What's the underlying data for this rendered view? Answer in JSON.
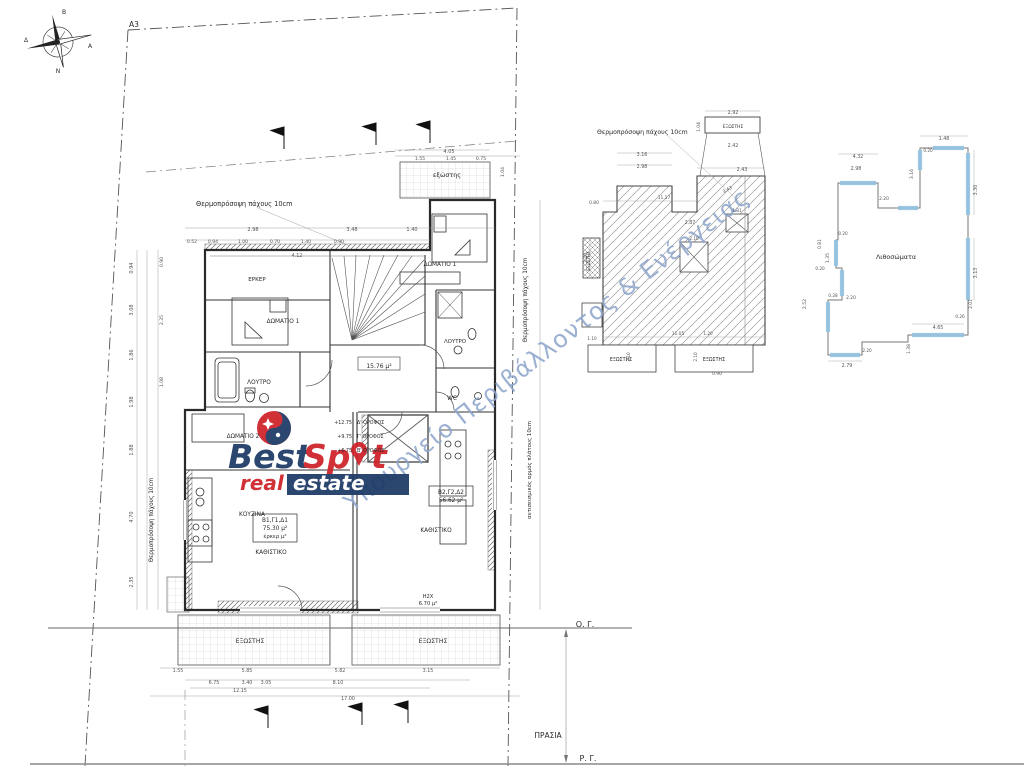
{
  "watermark": "Υπουργείο Περιβάλλοντος & Ενέργειας",
  "logo": {
    "best": "Best",
    "spot_left": "Sp",
    "spot_right": "t",
    "real": "real",
    "estate": "estate",
    "red": "#cf2128",
    "navy": "#1c3a66"
  },
  "site": {
    "corner_label": "A3",
    "building_line": "Ο. Γ.",
    "street_line": "Ρ. Γ.",
    "front_garden": "ΠΡΑΣΙΑ"
  },
  "labels": [
    {
      "n": "label-a3",
      "t": "A3",
      "x": 134,
      "y": 27,
      "s": 7.5
    },
    {
      "n": "compass-n-label",
      "t": "Β",
      "x": 64,
      "y": 14,
      "s": 6
    },
    {
      "n": "compass-s-label",
      "t": "Ν",
      "x": 58,
      "y": 73,
      "s": 6
    },
    {
      "n": "compass-e-label",
      "t": "Α",
      "x": 90,
      "y": 48,
      "s": 6
    },
    {
      "n": "compass-w-label",
      "t": "Δ",
      "x": 26,
      "y": 42,
      "s": 6
    },
    {
      "n": "anno-thermo-top",
      "t": "Θερμοπρόσοψη πάχους 10cm",
      "x": 196,
      "y": 206,
      "s": 6.6,
      "a": "start"
    },
    {
      "n": "label-exostis-small",
      "t": "εξώστης",
      "x": 447,
      "y": 177,
      "s": 6.4
    },
    {
      "n": "label-domatio1-right",
      "t": "ΔΩΜΑΤΙΟ 1",
      "x": 440,
      "y": 266,
      "s": 5.8
    },
    {
      "n": "label-erker",
      "t": "ΕΡΚΕΡ",
      "x": 257,
      "y": 281,
      "s": 5.6
    },
    {
      "n": "label-domatio1-left",
      "t": "ΔΩΜΑΤΙΟ 1",
      "x": 283,
      "y": 323,
      "s": 5.8
    },
    {
      "n": "label-loutro-left",
      "t": "ΛΟΥΤΡΟ",
      "x": 259,
      "y": 384,
      "s": 5.8
    },
    {
      "n": "label-area-1576",
      "t": "15.76 μ²",
      "x": 379,
      "y": 368,
      "s": 6
    },
    {
      "n": "label-loutro-right",
      "t": "ΛΟΥΤΡΟ",
      "x": 455,
      "y": 343,
      "s": 5.4
    },
    {
      "n": "label-wc",
      "t": "WC",
      "x": 452,
      "y": 400,
      "s": 5.8
    },
    {
      "n": "label-domatio2",
      "t": "ΔΩΜΑΤΙΟ 2",
      "x": 243,
      "y": 438,
      "s": 5.8
    },
    {
      "n": "label-kouzina",
      "t": "ΚΟΥΖΙΝΑ",
      "x": 252,
      "y": 516,
      "s": 5.8
    },
    {
      "n": "label-apt1-code",
      "t": "Β1,Γ1,Δ1",
      "x": 275,
      "y": 522,
      "s": 5.8
    },
    {
      "n": "label-apt1-area",
      "t": "75.30 μ²",
      "x": 275,
      "y": 530,
      "s": 5.8
    },
    {
      "n": "label-apt1-erker",
      "t": "έρκερ μ²",
      "x": 275,
      "y": 538,
      "s": 5.4
    },
    {
      "n": "label-kathistiko-left",
      "t": "ΚΑΘΙΣΤΙΚΟ",
      "x": 271,
      "y": 554,
      "s": 5.8
    },
    {
      "n": "label-apt2-code",
      "t": "Β2,Γ2,Δ2",
      "x": 451,
      "y": 494,
      "s": 5.8
    },
    {
      "n": "label-apt2-area",
      "t": "56.62 μ²",
      "x": 451,
      "y": 502,
      "s": 5.8
    },
    {
      "n": "label-kathistiko-right",
      "t": "ΚΑΘΙΣΤΙΚΟ",
      "x": 436,
      "y": 532,
      "s": 5.8
    },
    {
      "n": "label-h2x",
      "t": "Η2Χ",
      "x": 428,
      "y": 598,
      "s": 5.2
    },
    {
      "n": "label-h2x-area",
      "t": "6.70 μ²",
      "x": 428,
      "y": 605,
      "s": 5.2
    },
    {
      "n": "label-exostis-bl",
      "t": "ΕΞΩΣΤΗΣ",
      "x": 250,
      "y": 643,
      "s": 6.2
    },
    {
      "n": "label-exostis-br",
      "t": "ΕΞΩΣΤΗΣ",
      "x": 433,
      "y": 643,
      "s": 6.2
    },
    {
      "n": "floor-d-level",
      "t": "+12.75",
      "x": 352,
      "y": 424,
      "s": 4.8,
      "a": "end"
    },
    {
      "n": "floor-d-label",
      "t": "Δ' ΟΡΟΦΟΣ",
      "x": 357,
      "y": 424,
      "s": 4.8,
      "a": "start"
    },
    {
      "n": "floor-c-level",
      "t": "+9.75",
      "x": 352,
      "y": 438,
      "s": 4.8,
      "a": "end"
    },
    {
      "n": "floor-c-label",
      "t": "Γ' ΟΡΟΦΟΣ",
      "x": 357,
      "y": 438,
      "s": 4.8,
      "a": "start"
    },
    {
      "n": "floor-b-level",
      "t": "+6.75",
      "x": 352,
      "y": 452,
      "s": 4.8,
      "a": "end"
    },
    {
      "n": "floor-b-label",
      "t": "Β' ΟΡΟΦΟΣ",
      "x": 357,
      "y": 452,
      "s": 4.8,
      "a": "start"
    },
    {
      "n": "anno-thermo-left",
      "t": "Θερμοπρόσοψη πάχους 10cm",
      "x": 153,
      "y": 520,
      "s": 5.8,
      "r": -90
    },
    {
      "n": "anno-thermo-right",
      "t": "Θερμοπρόσοψη πάχους 10cm",
      "x": 527,
      "y": 300,
      "s": 5.8,
      "r": -90
    },
    {
      "n": "anno-seismic-joint",
      "t": "αντισεισμικός αρμός πλάτους 10cm",
      "x": 531,
      "y": 470,
      "s": 5.4,
      "r": -90
    },
    {
      "n": "label-og",
      "t": "Ο. Γ.",
      "x": 585,
      "y": 627,
      "s": 8
    },
    {
      "n": "label-prasia",
      "t": "ΠΡΑΣΙΑ",
      "x": 548,
      "y": 738,
      "s": 7.5
    },
    {
      "n": "label-rg",
      "t": "Ρ. Γ.",
      "x": 588,
      "y": 761,
      "s": 8
    },
    {
      "n": "anno-thermo-mid",
      "t": "Θερμοπρόσοψη πάχους 10cm",
      "x": 597,
      "y": 134,
      "s": 6.2,
      "a": "start"
    },
    {
      "n": "label-mid-exostis-top",
      "t": "ΕΞΩΣΤΗΣ",
      "x": 733,
      "y": 128,
      "s": 4.4
    },
    {
      "n": "label-mid-exostis-left",
      "t": "ΕΞΩΣΤΗΣ",
      "x": 590,
      "y": 261,
      "s": 4.2,
      "r": -90
    },
    {
      "n": "label-mid-exostis-bl",
      "t": "ΕΞΩΣΤΗΣ",
      "x": 621,
      "y": 361,
      "s": 4.8
    },
    {
      "n": "label-mid-exostis-br",
      "t": "ΕΞΩΣΤΗΣ",
      "x": 714,
      "y": 361,
      "s": 4.8
    },
    {
      "n": "label-lithosomata",
      "t": "Λιθοσώματα",
      "x": 896,
      "y": 259,
      "s": 6.4
    }
  ],
  "dims": [
    {
      "t": "4.05",
      "x": 449,
      "y": 153
    },
    {
      "t": "1.55",
      "x": 420,
      "y": 160,
      "s": 4.6
    },
    {
      "t": "1.45",
      "x": 451,
      "y": 160,
      "s": 4.6
    },
    {
      "t": "0.75",
      "x": 481,
      "y": 160,
      "s": 4.6
    },
    {
      "t": "1.04",
      "x": 504,
      "y": 172,
      "r": -90,
      "s": 4.6
    },
    {
      "t": "2.98",
      "x": 253,
      "y": 231
    },
    {
      "t": "3.48",
      "x": 352,
      "y": 231
    },
    {
      "t": "1.40",
      "x": 412,
      "y": 231
    },
    {
      "t": "0.52",
      "x": 192,
      "y": 243,
      "s": 4.6
    },
    {
      "t": "0.94",
      "x": 213,
      "y": 243,
      "s": 4.6
    },
    {
      "t": "1.00",
      "x": 243,
      "y": 243,
      "s": 4.6
    },
    {
      "t": "0.70",
      "x": 275,
      "y": 243,
      "s": 4.6
    },
    {
      "t": "1.40",
      "x": 306,
      "y": 243,
      "s": 4.6
    },
    {
      "t": "0.90",
      "x": 339,
      "y": 243,
      "s": 4.6
    },
    {
      "t": "4.12",
      "x": 297,
      "y": 257,
      "s": 4.8
    },
    {
      "t": "0.94",
      "x": 133,
      "y": 268,
      "r": -90
    },
    {
      "t": "3.08",
      "x": 133,
      "y": 310,
      "r": -90
    },
    {
      "t": "1.86",
      "x": 133,
      "y": 355,
      "r": -90
    },
    {
      "t": "1.98",
      "x": 133,
      "y": 402,
      "r": -90
    },
    {
      "t": "1.88",
      "x": 133,
      "y": 450,
      "r": -90
    },
    {
      "t": "4.70",
      "x": 133,
      "y": 517,
      "r": -90
    },
    {
      "t": "2.35",
      "x": 133,
      "y": 582,
      "r": -90
    },
    {
      "t": "0.90",
      "x": 163,
      "y": 262,
      "r": -90,
      "s": 4.6
    },
    {
      "t": "2.35",
      "x": 163,
      "y": 320,
      "r": -90,
      "s": 4.6
    },
    {
      "t": "1.08",
      "x": 163,
      "y": 382,
      "r": -90,
      "s": 4.6
    },
    {
      "t": "1.55",
      "x": 178,
      "y": 672,
      "s": 4.8
    },
    {
      "t": "5.85",
      "x": 247,
      "y": 672,
      "s": 4.8
    },
    {
      "t": "5.82",
      "x": 340,
      "y": 672,
      "s": 4.8
    },
    {
      "t": "3.15",
      "x": 428,
      "y": 672,
      "s": 4.8
    },
    {
      "t": "6.75",
      "x": 214,
      "y": 684,
      "s": 4.8
    },
    {
      "t": "3.40",
      "x": 247,
      "y": 684,
      "s": 4.8
    },
    {
      "t": "3.05",
      "x": 266,
      "y": 684,
      "s": 4.8
    },
    {
      "t": "8.10",
      "x": 338,
      "y": 684,
      "s": 4.8
    },
    {
      "t": "12.15",
      "x": 240,
      "y": 692,
      "s": 4.8
    },
    {
      "t": "17.00",
      "x": 348,
      "y": 700,
      "s": 4.8
    },
    {
      "t": "2.92",
      "x": 733,
      "y": 114,
      "s": 4.8
    },
    {
      "t": "1.04",
      "x": 700,
      "y": 127,
      "r": -90,
      "s": 4.4
    },
    {
      "t": "2.42",
      "x": 733,
      "y": 147,
      "s": 4.8
    },
    {
      "t": "3.16",
      "x": 642,
      "y": 156,
      "s": 4.8
    },
    {
      "t": "2.98",
      "x": 642,
      "y": 168,
      "s": 4.8
    },
    {
      "t": "2.43",
      "x": 742,
      "y": 171,
      "s": 4.8
    },
    {
      "t": "3.43",
      "x": 728,
      "y": 191,
      "r": -28,
      "s": 4.6
    },
    {
      "t": "11.17",
      "x": 664,
      "y": 199,
      "s": 4.4
    },
    {
      "t": "2.87",
      "x": 690,
      "y": 224,
      "s": 4.8
    },
    {
      "t": "0.80",
      "x": 594,
      "y": 204,
      "s": 4.4
    },
    {
      "t": "2.40",
      "x": 587,
      "y": 258,
      "r": -90,
      "s": 4.6
    },
    {
      "t": "1.31",
      "x": 737,
      "y": 212,
      "s": 4.2
    },
    {
      "t": "2.10",
      "x": 694,
      "y": 240,
      "s": 4.2
    },
    {
      "t": "1.10",
      "x": 592,
      "y": 340,
      "s": 4.2
    },
    {
      "t": "11.05",
      "x": 678,
      "y": 335,
      "s": 4.4
    },
    {
      "t": "1.20",
      "x": 708,
      "y": 335,
      "s": 4.2
    },
    {
      "t": "2.10",
      "x": 630,
      "y": 357,
      "r": -90,
      "s": 4.2
    },
    {
      "t": "2.10",
      "x": 697,
      "y": 357,
      "r": -90,
      "s": 4.2
    },
    {
      "t": "0.90",
      "x": 717,
      "y": 375,
      "s": 4.4
    },
    {
      "t": "1.48",
      "x": 944,
      "y": 140,
      "s": 4.8
    },
    {
      "t": "0.20",
      "x": 928,
      "y": 152,
      "s": 4.2
    },
    {
      "t": "4.32",
      "x": 858,
      "y": 158,
      "s": 4.8
    },
    {
      "t": "2.98",
      "x": 856,
      "y": 170,
      "s": 4.8
    },
    {
      "t": "3.16",
      "x": 913,
      "y": 174,
      "r": -90,
      "s": 4.6
    },
    {
      "t": "2.20",
      "x": 884,
      "y": 200,
      "s": 4.4
    },
    {
      "t": "3.30",
      "x": 977,
      "y": 190,
      "r": -90,
      "s": 4.8
    },
    {
      "t": "3.13",
      "x": 977,
      "y": 273,
      "r": -90,
      "s": 4.8
    },
    {
      "t": "2.01",
      "x": 972,
      "y": 304,
      "r": -90,
      "s": 4.4
    },
    {
      "t": "0.26",
      "x": 960,
      "y": 318,
      "s": 4.2
    },
    {
      "t": "4.65",
      "x": 938,
      "y": 329,
      "s": 4.8
    },
    {
      "t": "1.38",
      "x": 910,
      "y": 349,
      "r": -90,
      "s": 4.4
    },
    {
      "t": "1.35",
      "x": 829,
      "y": 258,
      "r": -90,
      "s": 4.6
    },
    {
      "t": "0.20",
      "x": 843,
      "y": 235,
      "s": 4.2
    },
    {
      "t": "0.81",
      "x": 821,
      "y": 244,
      "r": -90,
      "s": 4.4
    },
    {
      "t": "2.20",
      "x": 851,
      "y": 299,
      "s": 4.4
    },
    {
      "t": "0.20",
      "x": 820,
      "y": 270,
      "s": 4.2
    },
    {
      "t": "0.28",
      "x": 833,
      "y": 297,
      "s": 4.2
    },
    {
      "t": "2.52",
      "x": 806,
      "y": 304,
      "r": -90,
      "s": 4.6
    },
    {
      "t": "2.79",
      "x": 847,
      "y": 367,
      "s": 4.8
    },
    {
      "t": "2.20",
      "x": 867,
      "y": 352,
      "s": 4.2
    }
  ]
}
